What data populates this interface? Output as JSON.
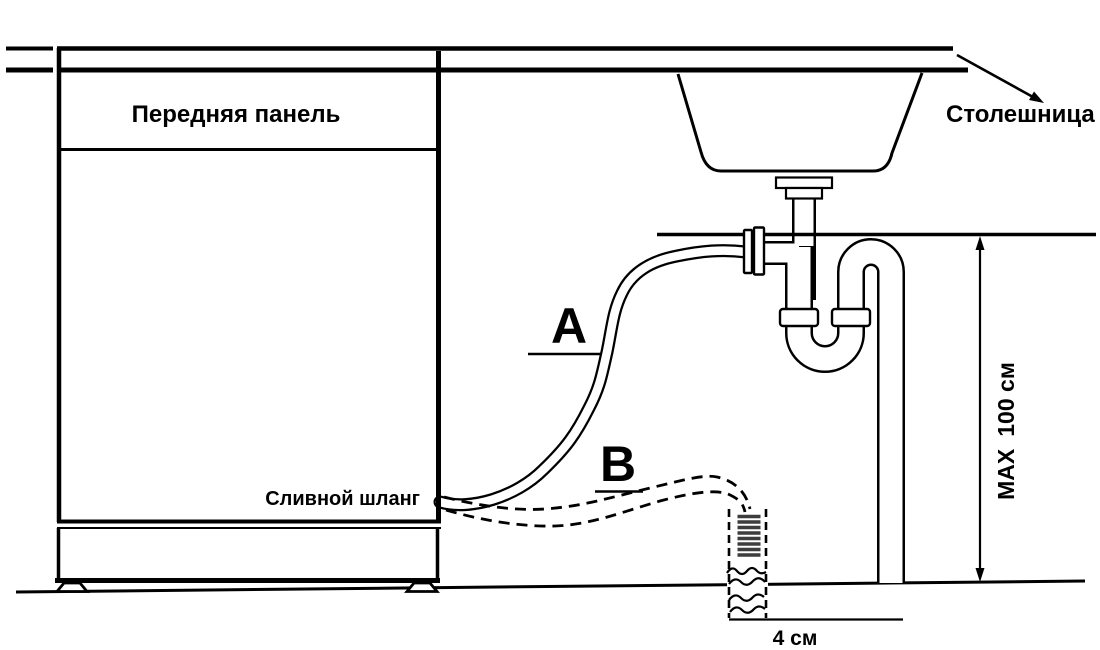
{
  "diagram": {
    "front_panel_label": "Передняя панель",
    "countertop_label": "Столешница",
    "drain_hose_label": "Сливной шланг",
    "option_a_label": "A",
    "option_b_label": "B",
    "max_prefix": "MAX",
    "max_height": "100 см",
    "standpipe_width": "4 см"
  },
  "colors": {
    "line": "#000000",
    "background": "#ffffff",
    "hatch": "#3d3d3d"
  }
}
